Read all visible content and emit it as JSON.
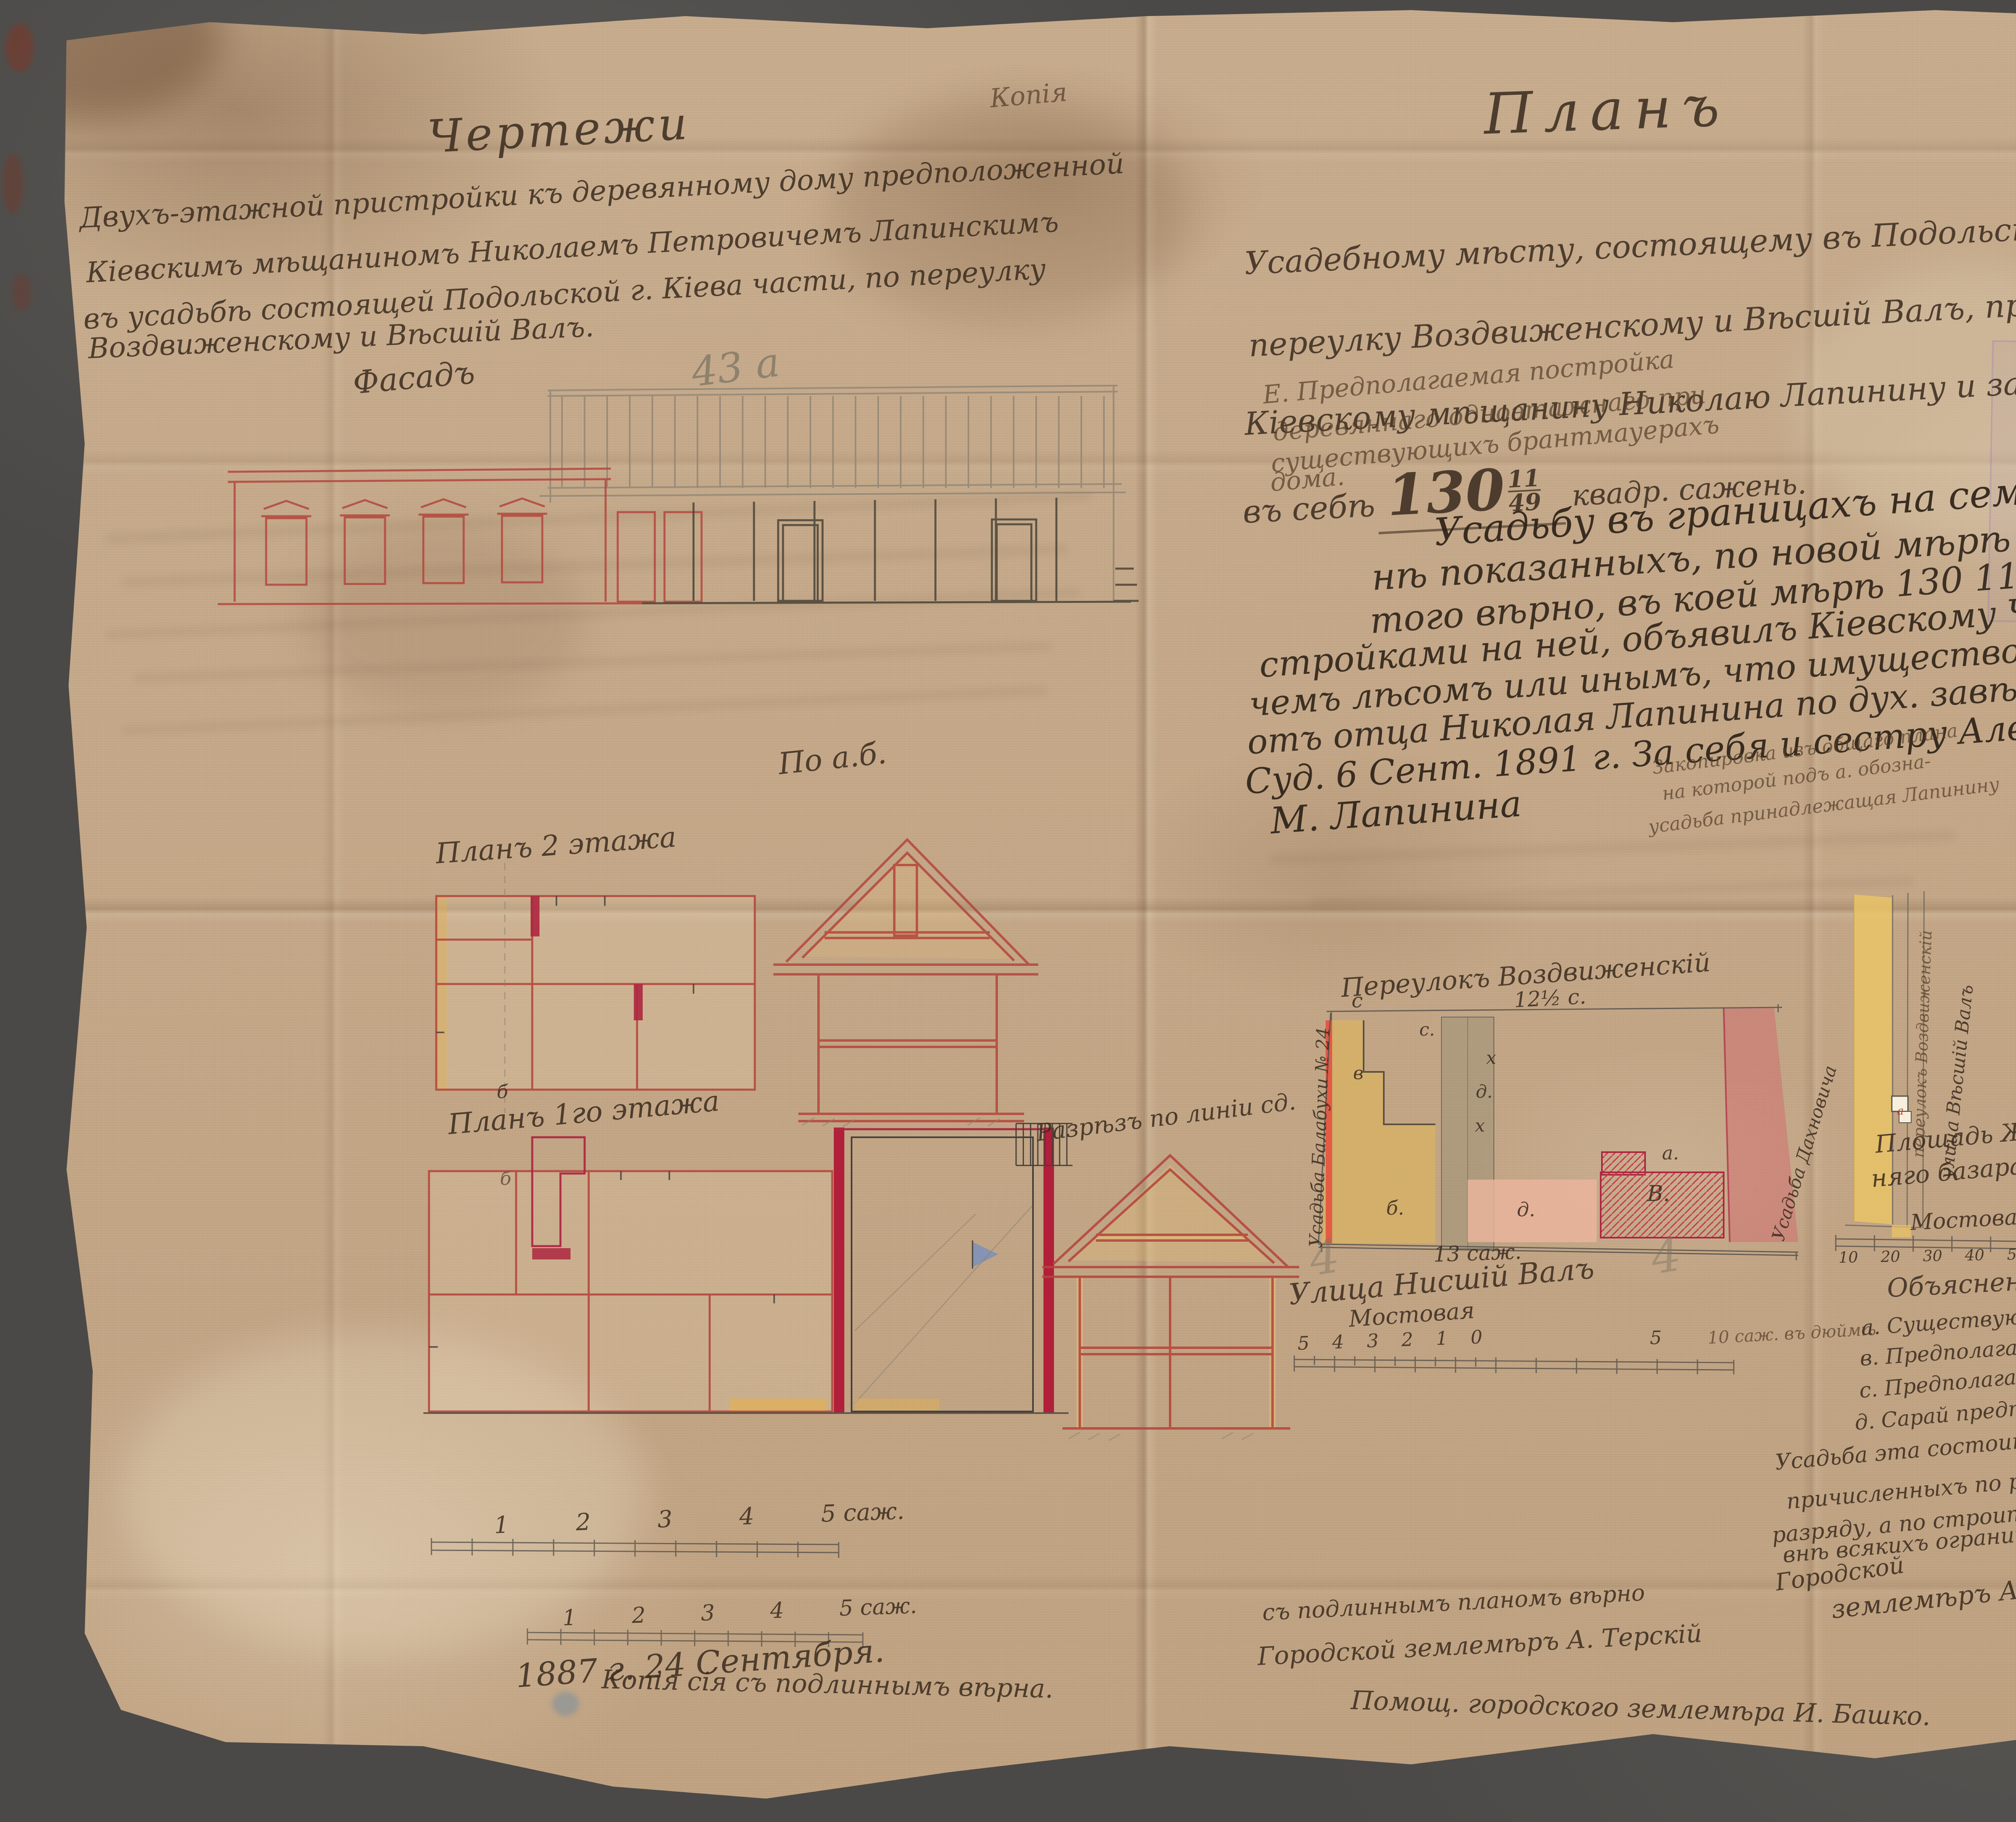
{
  "meta": {
    "copy_label": "Копія"
  },
  "left": {
    "title": "Чертежи",
    "body_lines": [
      "Двухъ-этажной пристройки къ деревянному дому предположенной",
      "Кіевскимъ мѣщаниномъ Николаемъ Петровичемъ Лапинскимъ",
      "въ усадьбѣ состоящей Подольской г. Кіева части, по переулку",
      "Воздвиженскому и Вѣсшій Валъ."
    ],
    "facade_label": "Фасадъ",
    "facade_number": "43 а",
    "section_ab_label": "По а.б.",
    "plan2_label": "Планъ 2 этажа",
    "plan1_label": "Планъ 1го этажа",
    "section_cd_label": "Разрѣзъ по линіи сд.",
    "marker_b1": "б",
    "marker_b2": "б",
    "scale1_numbers": "1         2         3         4         5 саж.",
    "scale2_numbers": "1        2        3        4        5 саж."
  },
  "right": {
    "title": "Планъ",
    "intro_lines": [
      "Усадебному мѣсту, состоящему въ Подольской г. Кіева части по",
      "переулку Воздвиженскому и Вѣсшій Валъ, принадлежащему",
      "Кіевскому мѣщанину Николаю Лапинину и заключающему"
    ],
    "area_prefix": "въ себѣ",
    "area_value": "130",
    "area_num": "11",
    "area_den": "49",
    "area_suffix": "квадр. сажень.",
    "e_lines": [
      "Е. Предполагаемая постройка",
      "деревяннаго одноэтажнаго при",
      "существующихъ брантмауерахъ",
      "дома."
    ],
    "big_lines": [
      "Усадьбу въ границахъ на семъ пла-",
      "нѣ показанныхъ, по новой мѣрѣ съ по-",
      "того вѣрно, въ коей мѣрѣ 130 11/49 кв. с. со-",
      "стройками на ней, объявилъ Кіевскому Чиновнику пр-",
      "чемъ лѣсомъ или инымъ, что имущество досталось намъ",
      "отъ отца Николая Лапинина по дух. завѣщ., увѣр. Кіев. Окр.",
      "Суд. 6 Сент. 1891 г.      За себя и сестру Алексѣй П. Лапининъ"
    ],
    "big_sign2": "М. Лапинина",
    "note_lines": [
      "Закопировка изъ общаго плана",
      "на которой подъ а. обозна-",
      "усадьба принадлежащая Лапинину"
    ]
  },
  "siteplan": {
    "street_top": "Переулокъ Воздвиженскій",
    "corner_c": "с",
    "dim_top": "12½ с.",
    "left_estate": "Усадьба Балабухи № 24",
    "right_estate": "Усадьба Дахновича",
    "letters": {
      "c": "с.",
      "v": "в",
      "x1": "х",
      "d1": "д.",
      "x2": "х",
      "b": "б.",
      "d2": "д.",
      "V": "В.",
      "a": "а."
    },
    "pencil4a": "4",
    "pencil4b": "4",
    "dim_bottom": "13 саж.",
    "street_bottom": "Улица Нисшій Валъ",
    "pavement": "Мостовая",
    "scale_numbers": "5 4 3 2 1 0",
    "scale_five": "5",
    "scale_label": "10 саж. въ дюймѣ"
  },
  "keyplan": {
    "lane_label": "переулокъ Воздвиженскій",
    "street_label": "улица Вѣсшій Валъ",
    "square_line1": "Площадь Жит-",
    "square_line2": "няго базара",
    "pavement": "Мостовая",
    "marker_a": "а",
    "scale_numbers": "10 20 30 40 50",
    "scale_label": "100 саж. для выкопировки"
  },
  "explanation": {
    "heading": "Объясненіе",
    "items": [
      "а. Существующій домъ.",
      "в. Предполагаемый домъ",
      "с. Предполагаемый сарай",
      "д. Сарай предположенный къ сломкѣ."
    ],
    "para_lines": [
      "Усадьба эта состоитъ по линейнымъ улицъ",
      "причисленныхъ по росписанію къ Четвертому",
      "разряду, а по строительнымъ правиламъ",
      "внѣ всякихъ ограниченій."
    ],
    "signature_line1": "Городской",
    "signature_line2": "землемѣръ А. Терскій"
  },
  "bottom": {
    "verify_line": "съ подлиннымъ планомъ вѣрно",
    "surveyor": "Городской землемѣръ А. Терскій",
    "date": "1887 г. 24 Сентября.",
    "copy_part1": "Копія сія съ подлиннымъ вѣрна.",
    "copy_part2": "Помощ. городского землемѣра И. Башко."
  }
}
